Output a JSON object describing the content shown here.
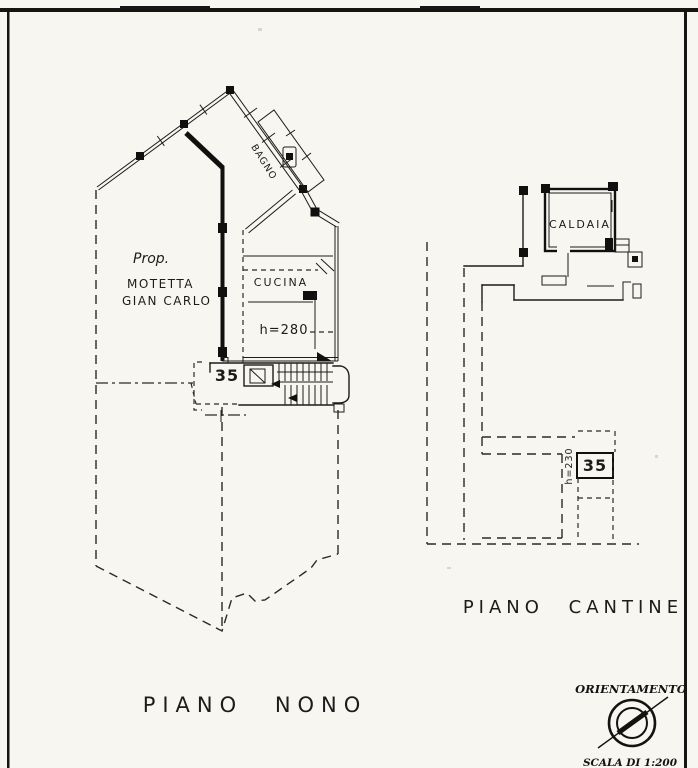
{
  "colors": {
    "ink": "#1d1c1a",
    "paper": "#f7f6f1"
  },
  "plan_left": {
    "caption": "PIANO NONO",
    "owner": {
      "line1": "Prop.",
      "line2": "MOTETTA",
      "line3": "GIAN CARLO"
    },
    "rooms": {
      "bagno": "BAGNO",
      "cucina": "CUCINA"
    },
    "height_note": "h=280",
    "unit_number": "35"
  },
  "plan_right": {
    "caption": "PIANO CANTINE",
    "rooms": {
      "caldaia": "CALDAIA"
    },
    "height_note": "h=230",
    "unit_number": "35"
  },
  "legend": {
    "orientation": "ORIENTAMENTO",
    "scale": "SCALA DI 1:200"
  }
}
